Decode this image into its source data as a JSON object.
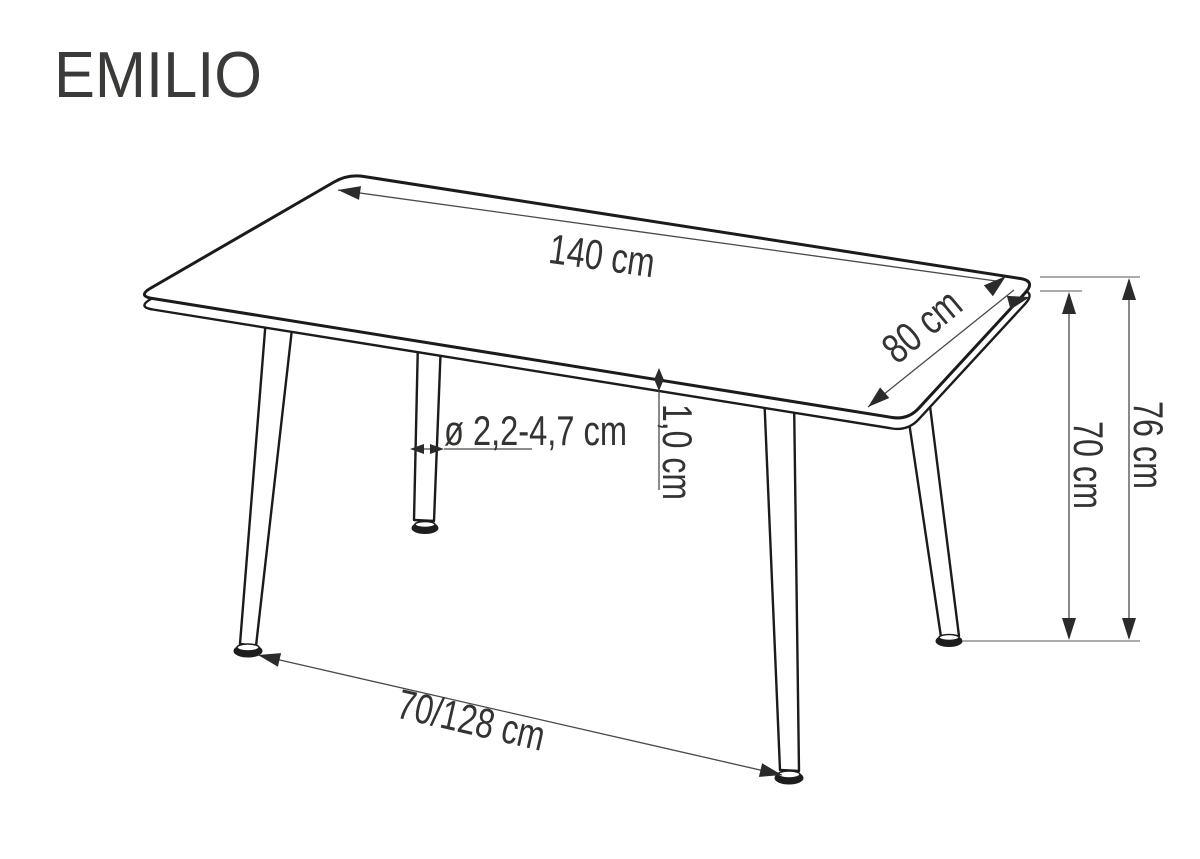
{
  "header": {
    "title": "EMILIO"
  },
  "diagram": {
    "type": "furniture-dimension-drawing",
    "dimensions": {
      "length": "140 cm",
      "depth": "80 cm",
      "total_height": "76 cm",
      "under_top_height": "70 cm",
      "top_thickness": "1,0 cm",
      "leg_diameter": "ø 2,2-4,7 cm",
      "leg_span_floor": "70/128 cm"
    }
  },
  "colors": {
    "background": "#ffffff",
    "outline": "#1b1b1b",
    "dimension_line": "#4a4a4a",
    "arrowhead": "#2b2b2b",
    "text": "#333331"
  }
}
